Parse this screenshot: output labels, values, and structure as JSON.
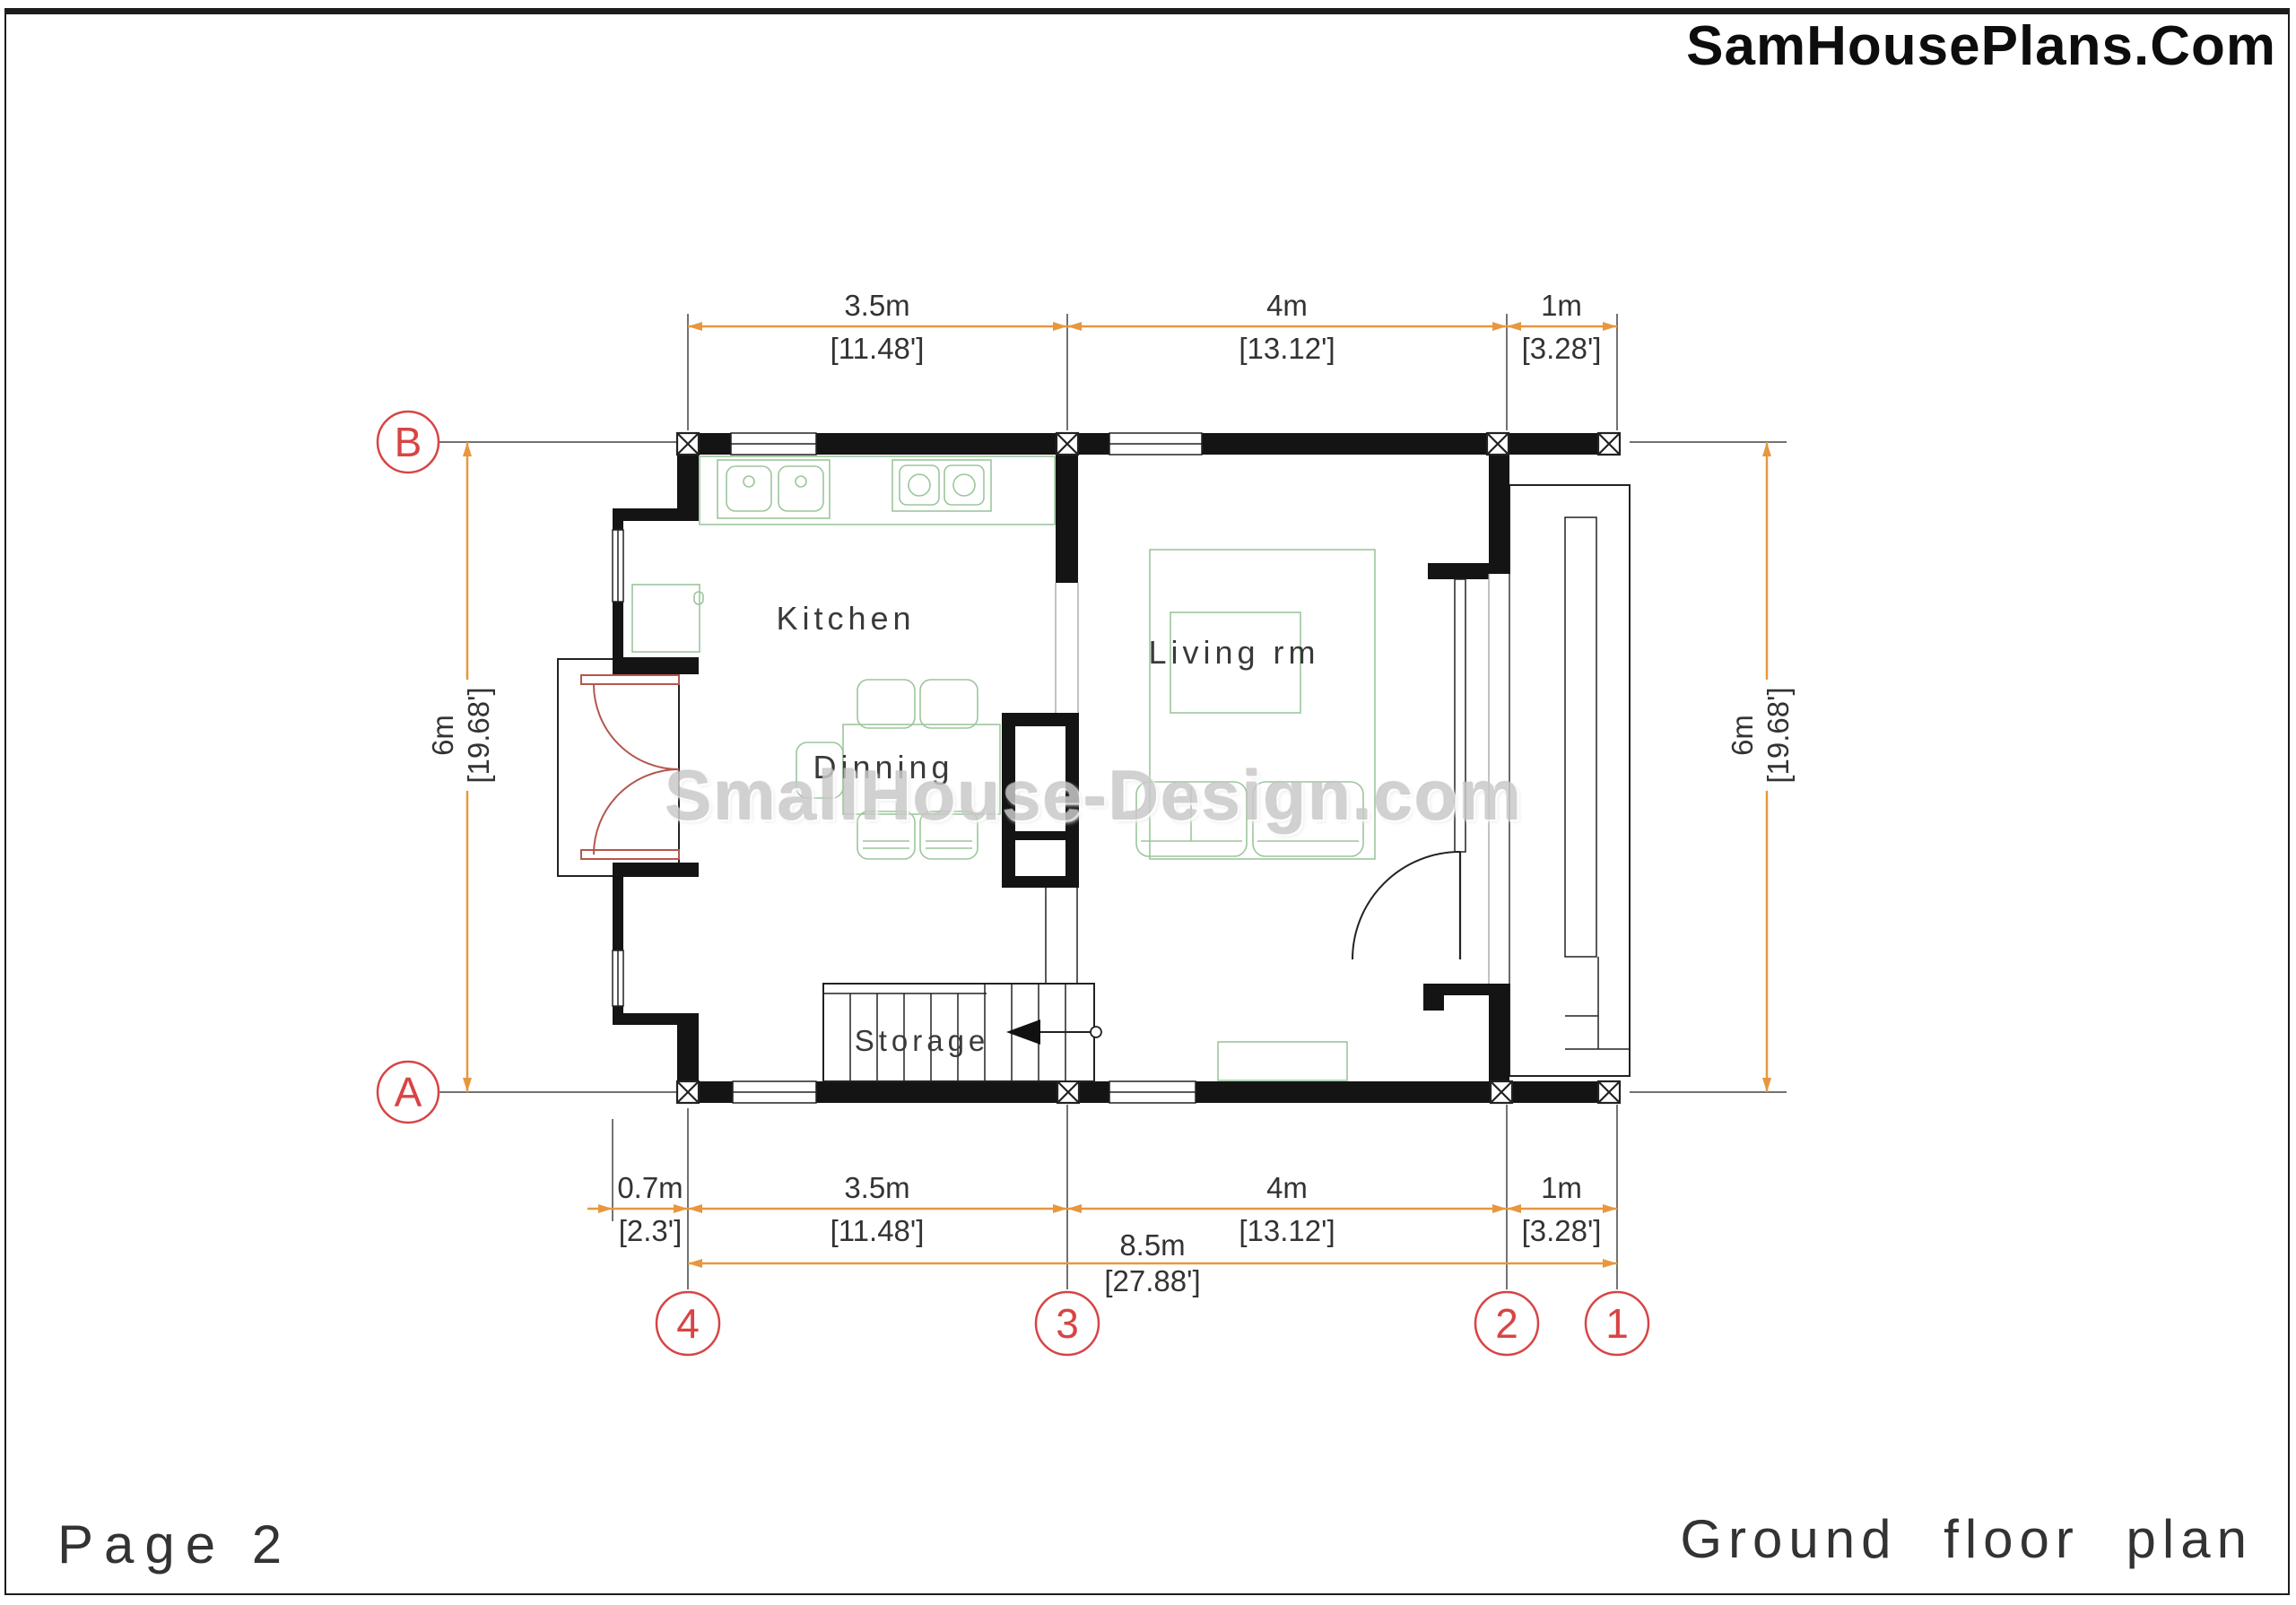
{
  "title": "SamHousePlans.Com",
  "footer": {
    "page_label": "Page 2",
    "plan_title": "Ground floor plan"
  },
  "watermark": "SmallHouse-Design.com",
  "rooms": {
    "kitchen": "Kitchen",
    "dining": "Dinning",
    "living": "Living rm",
    "storage": "Storage"
  },
  "grid": {
    "row_labels": [
      "B",
      "A"
    ],
    "col_labels": [
      "4",
      "3",
      "2",
      "1"
    ]
  },
  "dimensions": {
    "top": [
      {
        "m": "3.5m",
        "ft": "[11.48']"
      },
      {
        "m": "4m",
        "ft": "[13.12']"
      },
      {
        "m": "1m",
        "ft": "[3.28']"
      }
    ],
    "bottom": [
      {
        "m": "0.7m",
        "ft": "[2.3']"
      },
      {
        "m": "3.5m",
        "ft": "[11.48']"
      },
      {
        "m": "4m",
        "ft": "[13.12']"
      },
      {
        "m": "1m",
        "ft": "[3.28']"
      }
    ],
    "bottom_total": {
      "m": "8.5m",
      "ft": "[27.88']"
    },
    "left": {
      "m": "6m",
      "ft": "[19.68']"
    },
    "right": {
      "m": "6m",
      "ft": "[19.68']"
    }
  },
  "colors": {
    "dimension_line": "#E8973F",
    "grid_bubble": "#D84444",
    "door_swing": "#B4574E",
    "furniture_outline": "#9CC69C",
    "wall_fill": "#141414"
  }
}
